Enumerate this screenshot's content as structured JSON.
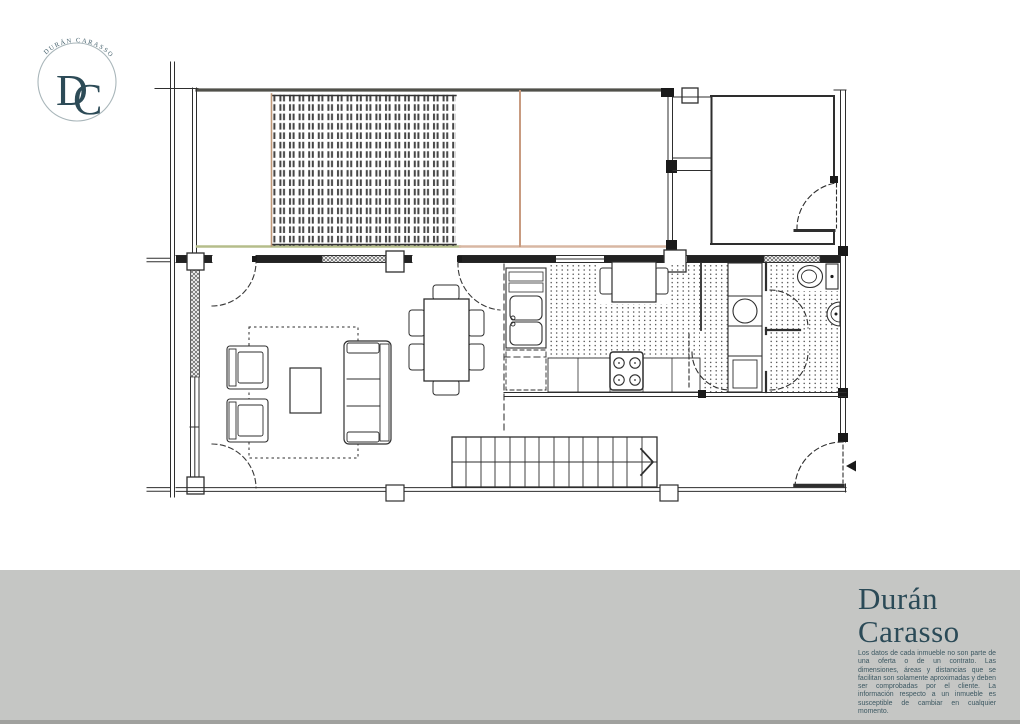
{
  "logo": {
    "arc_text": "DURÁN CARASSO",
    "monogram": {
      "d": "D",
      "c": "C"
    }
  },
  "plan": {
    "type": "floor-plan",
    "colors": {
      "line": "#2e2e2e",
      "terrace_top_edge": "#50504a",
      "terrace_bottom_edge_green": "#b5bd8b",
      "terrace_bottom_edge_pink": "#d8b7a3",
      "terrace_divider_tan": "#c89b80",
      "decking_border_tan": "#c09878"
    },
    "icons": {
      "entrance_arrow": "◄",
      "stairs_direction_arrow": "›"
    }
  },
  "footer": {
    "brand_line1": "Durán",
    "brand_line2": "Carasso",
    "brand_color": "#2b4a57",
    "bar_color": "#c5c6c4",
    "edge_color": "#a0a19e",
    "disclaimer": "Los datos de cada inmueble no son parte de una oferta o de un contrato. Las dimensiones, áreas y distancias que se facilitan son solamente aproximadas y deben ser comprobadas por el cliente. La información respecto a un inmueble es susceptible de cambiar en cualquier momento."
  }
}
